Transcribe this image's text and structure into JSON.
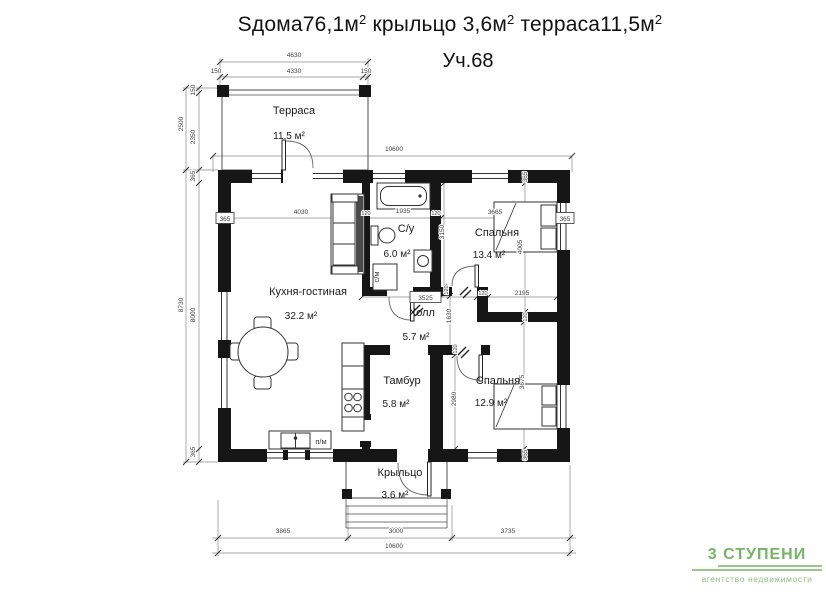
{
  "title": {
    "p1": "Sдома76,1м",
    "s1": "2",
    "p2": " крыльцо 3,6м",
    "s2": "2",
    "p3": " терраса11,5м",
    "s3": "2",
    "subtitle": "Уч.68"
  },
  "rooms": {
    "terrace": {
      "name": "Терраса",
      "area": "11.5 м²"
    },
    "kitchen": {
      "name": "Кухня-гостиная",
      "area": "32.2 м²"
    },
    "bath": {
      "name": "С/у",
      "area": "6.0 м²"
    },
    "bedroom1": {
      "name": "Спальня",
      "area": "13.4 м²"
    },
    "hall": {
      "name": "Холл",
      "area": "5.7 м²"
    },
    "tambour": {
      "name": "Тамбур",
      "area": "5.8 м²"
    },
    "bedroom2": {
      "name": "Спальня",
      "area": "12.9 м²"
    },
    "porch": {
      "name": "Крыльцо",
      "area": "3.6 м²"
    }
  },
  "appliances": {
    "dishwasher": "п/м",
    "washer": "с/м"
  },
  "dims": {
    "terrace_total": "4630",
    "terrace_left": "150",
    "terrace_mid": "4330",
    "terrace_right": "150",
    "top_overall": "10600",
    "terrace_h_total": "2500",
    "terrace_h_offset": "150",
    "terrace_h_inner": "2350",
    "left_total": "8730",
    "left_wall_top": "365",
    "left_inner": "8000",
    "left_wall_bottom": "365",
    "wall_left_box": "365",
    "wall_right_box": "365",
    "wall_top_right": "365",
    "wall_bottom_right": "365",
    "kitchen_w": "4030",
    "w120_a": "120",
    "bath_w": "1935",
    "w120_b": "120",
    "bedroom1_w": "3665",
    "bedroom1_h": "3150",
    "bedroom1_h2": "4005",
    "hall_w": "3525",
    "w120_c": "120",
    "bedroom1_s": "2195",
    "w120_d": "120",
    "hall_h": "1630",
    "w120_e": "120",
    "bedroom2_h": "2980",
    "w120_f": "120",
    "bedroom2_h2": "3675",
    "bottom_a": "3865",
    "bottom_b": "3000",
    "bottom_c": "3735",
    "bottom_overall": "10600"
  },
  "logo": {
    "name": "3 СТУПЕНИ",
    "subtitle": "агентство недвижимости",
    "accent": "#76b465"
  },
  "colors": {
    "wall": "#161616",
    "line": "#4d4d4d",
    "dim_line": "#8a8a8a"
  }
}
